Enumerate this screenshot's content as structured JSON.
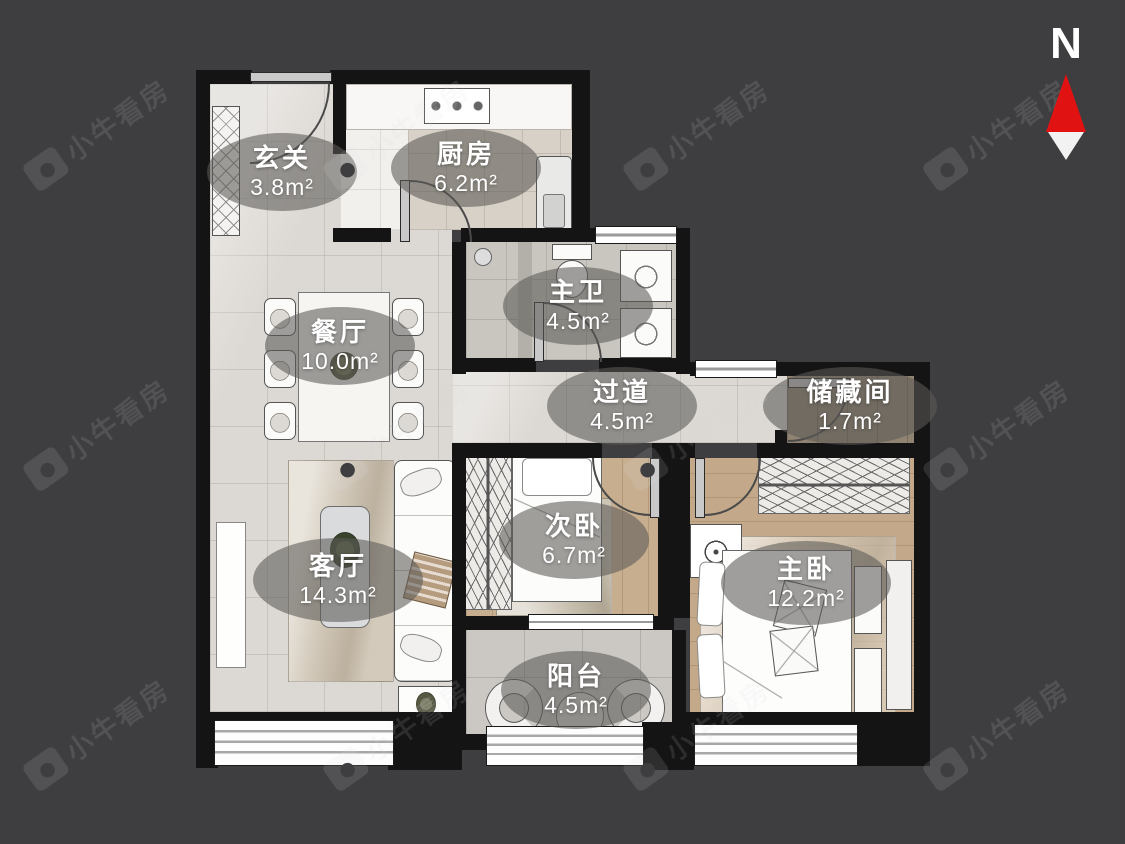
{
  "compass": {
    "label": "N"
  },
  "watermark": {
    "text": "小牛看房"
  },
  "rooms": [
    {
      "name": "玄关",
      "area": "3.8m²"
    },
    {
      "name": "厨房",
      "area": "6.2m²"
    },
    {
      "name": "主卫",
      "area": "4.5m²"
    },
    {
      "name": "餐厅",
      "area": "10.0m²"
    },
    {
      "name": "过道",
      "area": "4.5m²"
    },
    {
      "name": "储藏间",
      "area": "1.7m²"
    },
    {
      "name": "次卧",
      "area": "6.7m²"
    },
    {
      "name": "客厅",
      "area": "14.3m²"
    },
    {
      "name": "主卧",
      "area": "12.2m²"
    },
    {
      "name": "阳台",
      "area": "4.5m²"
    }
  ],
  "colors": {
    "background": "#3e3e40",
    "wall": "#141414",
    "compass_needle_north": "#e01212",
    "compass_needle_south": "#f2f2f2",
    "label_bubble": "rgba(92,90,87,0.58)"
  }
}
